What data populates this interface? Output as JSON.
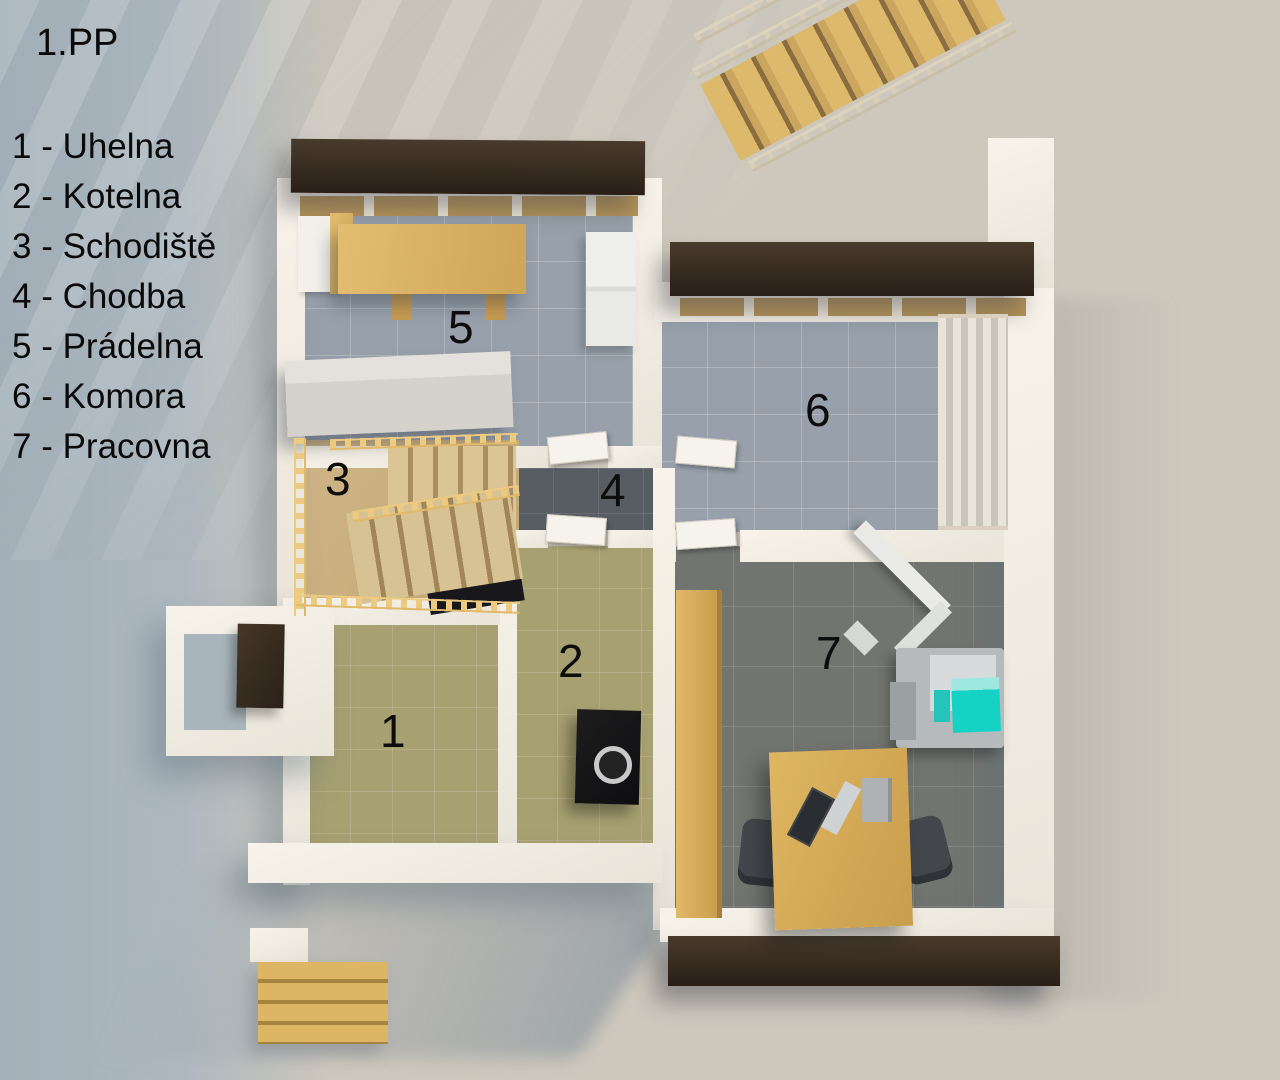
{
  "title": "1.PP",
  "legend": {
    "items": [
      {
        "text": "1 - Uhelna"
      },
      {
        "text": "2 - Kotelna"
      },
      {
        "text": "3 - Schodiště"
      },
      {
        "text": "4 - Chodba"
      },
      {
        "text": "5 - Prádelna"
      },
      {
        "text": "6 - Komora"
      },
      {
        "text": "7 - Pracovna"
      }
    ]
  },
  "plan": {
    "room_numbers": {
      "uhelna": "1",
      "kotelna": "2",
      "schodiste": "3",
      "chodba": "4",
      "pradelna": "5",
      "komora": "6",
      "pracovna": "7"
    }
  },
  "colors": {
    "background": "#cdc7bc",
    "background_shadow_blue": "#a9b5bd",
    "wall_white": "#f1ede4",
    "floor_tile_gray": "#97a0ab",
    "floor_olive": "#a7a071",
    "floor_office_dark": "#71746f",
    "floor_hall_dark": "#585d63",
    "wood_light": "#d9b566",
    "stair_wood": "#cdb383",
    "beam_dark_brown": "#392e22",
    "boiler_black": "#161617",
    "machine_cyan": "#15d3c4"
  }
}
